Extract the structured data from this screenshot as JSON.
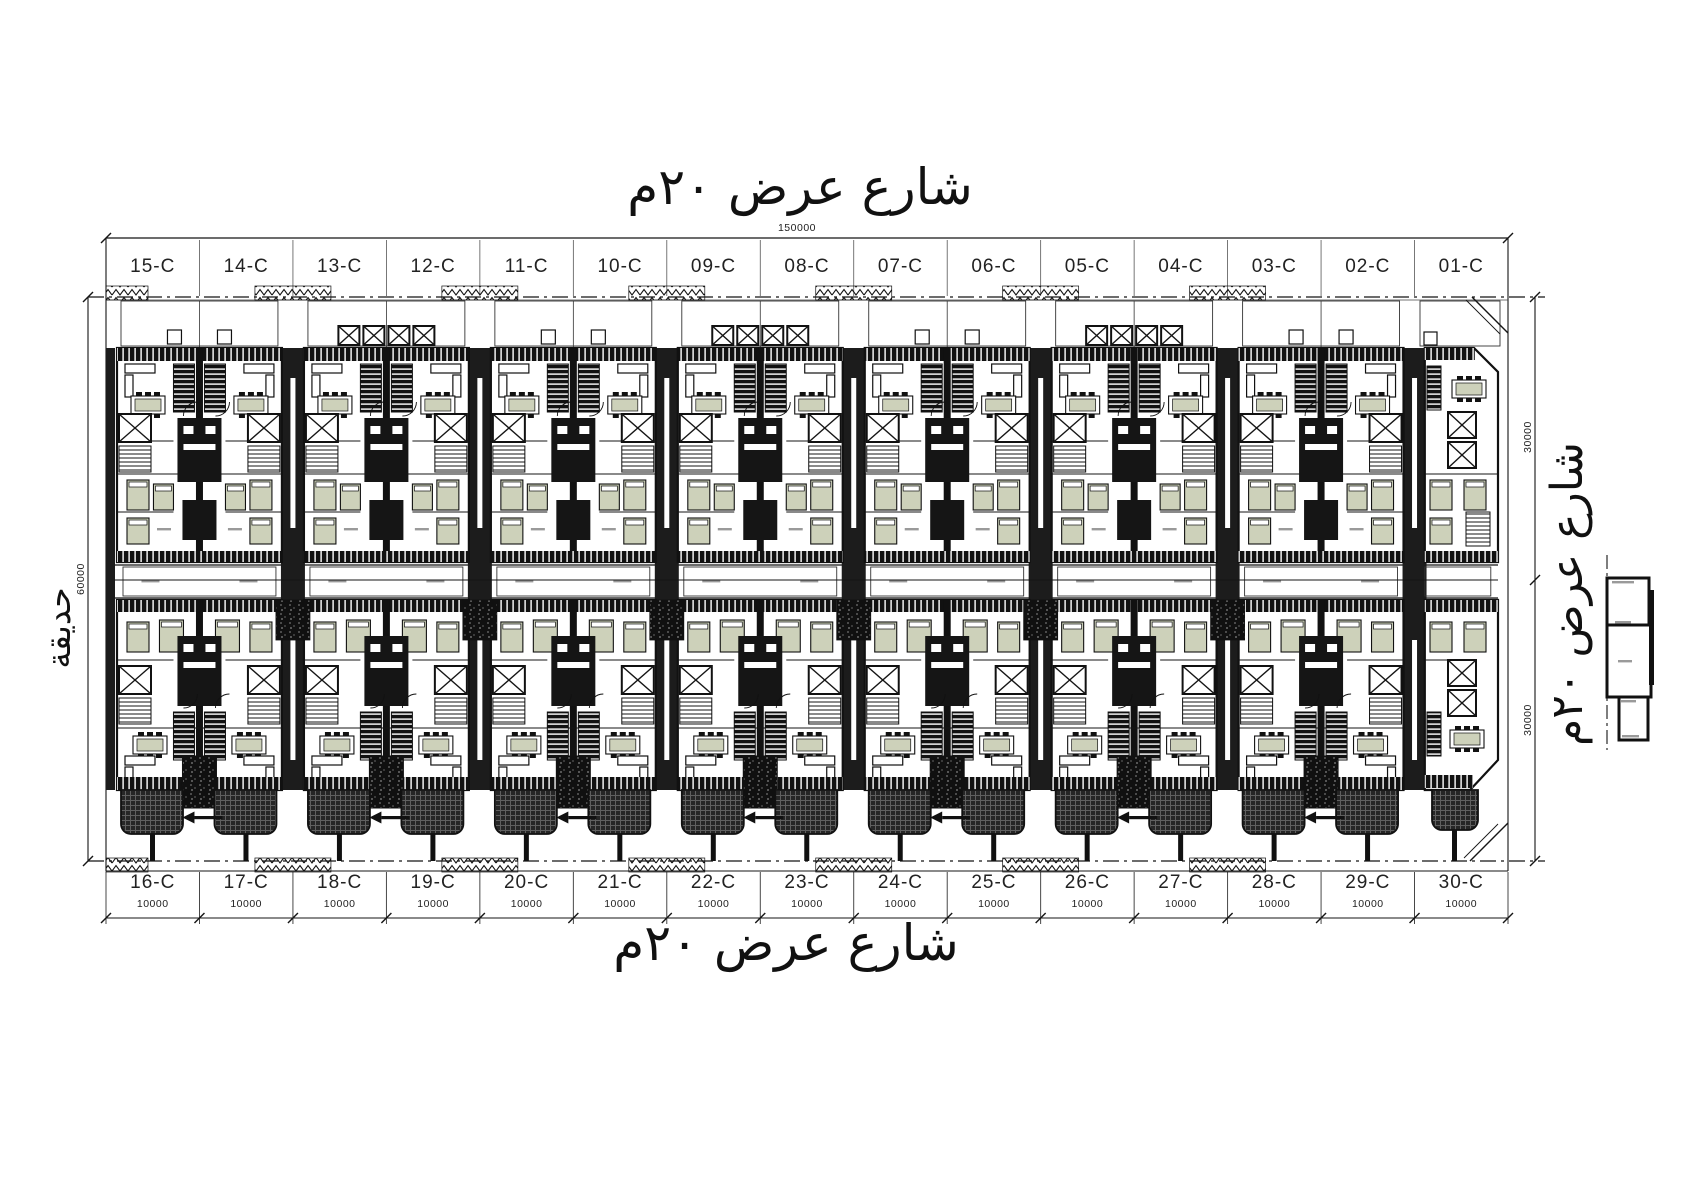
{
  "streets": {
    "top": "شارع عرض ٢٠م",
    "bottom": "شارع عرض ٢٠م",
    "right": "شارع عرض ٢٠م",
    "garden": "حديقة"
  },
  "dimensions": {
    "overall_width": "150000",
    "overall_depth": "60000",
    "upper_plot_depth": "30000",
    "lower_plot_depth": "30000",
    "unit_width": "10000"
  },
  "units": {
    "top_row": [
      "15-C",
      "14-C",
      "13-C",
      "12-C",
      "11-C",
      "10-C",
      "09-C",
      "08-C",
      "07-C",
      "06-C",
      "05-C",
      "04-C",
      "03-C",
      "02-C",
      "01-C"
    ],
    "bottom_row": [
      "16-C",
      "17-C",
      "18-C",
      "19-C",
      "20-C",
      "21-C",
      "22-C",
      "23-C",
      "24-C",
      "25-C",
      "26-C",
      "27-C",
      "28-C",
      "29-C",
      "30-C"
    ]
  },
  "bottom_dims": [
    "10000",
    "10000",
    "10000",
    "10000",
    "10000",
    "10000",
    "10000",
    "10000",
    "10000",
    "10000",
    "10000",
    "10000",
    "10000",
    "10000",
    "10000"
  ],
  "colors": {
    "line": "#151515",
    "furniture": "#cdd1ba",
    "dark_fill": "#1c1c1c"
  }
}
